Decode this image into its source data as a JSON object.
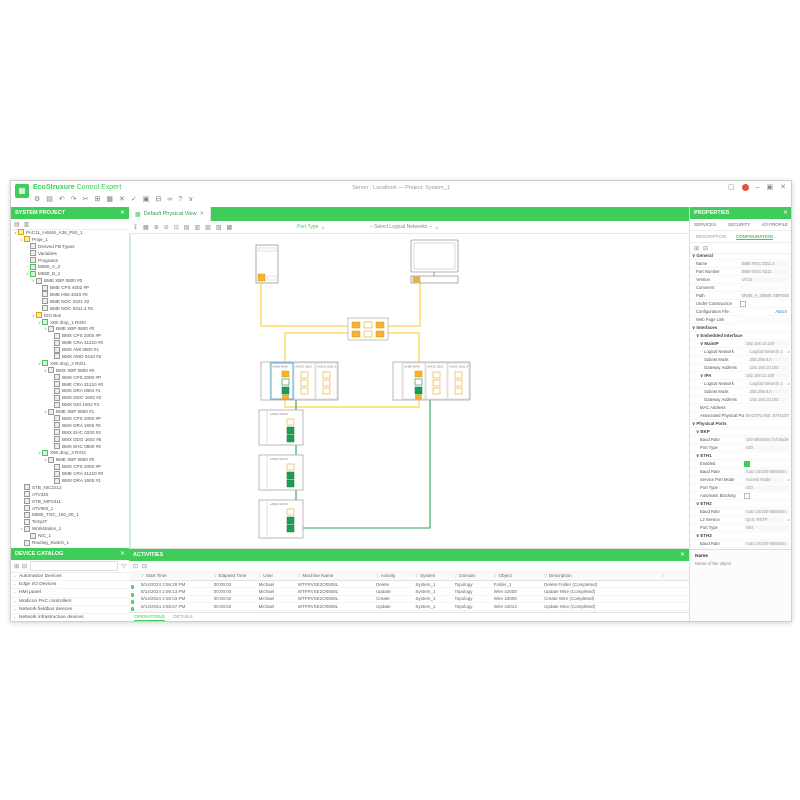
{
  "window": {
    "brand_primary": "EcoStruxure",
    "brand_secondary": "Control Expert",
    "title_center": "Server : Localhost — Project: System_1",
    "logo_glyph": "▦",
    "controls": [
      {
        "name": "layout-icon",
        "g": "▢"
      },
      {
        "name": "record-indicator",
        "g": "●"
      },
      {
        "name": "minimize-icon",
        "g": "–"
      },
      {
        "name": "maximize-icon",
        "g": "▣"
      },
      {
        "name": "close-icon",
        "g": "✕"
      }
    ]
  },
  "main_toolbar": {
    "icons": [
      {
        "name": "settings-icon",
        "g": "⚙"
      },
      {
        "name": "open-project-icon",
        "g": "▤"
      },
      {
        "name": "undo-icon",
        "g": "↶"
      },
      {
        "name": "redo-icon",
        "g": "↷"
      },
      {
        "name": "cut-icon",
        "g": "✂"
      },
      {
        "name": "copy-icon",
        "g": "⊞"
      },
      {
        "name": "paste-icon",
        "g": "▦"
      },
      {
        "name": "delete-icon",
        "g": "✕"
      },
      {
        "name": "validate-icon",
        "g": "✓"
      },
      {
        "name": "build-icon",
        "g": "▣"
      },
      {
        "name": "print-icon",
        "g": "⊟"
      },
      {
        "name": "refresh-icon",
        "g": "∞"
      },
      {
        "name": "help-icon",
        "g": "?"
      },
      {
        "name": "more-icon",
        "g": "∨"
      }
    ]
  },
  "left": {
    "project_panel": {
      "title": "SYSTEM PROJECT",
      "close_glyph": "✕",
      "tool_icons": [
        {
          "name": "expand-all-icon",
          "g": "▤"
        },
        {
          "name": "collapse-all-icon",
          "g": "▥"
        }
      ],
      "tree": [
        {
          "d": 0,
          "e": "v",
          "k": "f",
          "t": "PAC11_H4848_A38_P82_1"
        },
        {
          "d": 1,
          "e": "v",
          "k": "f",
          "t": "Proje_1"
        },
        {
          "d": 2,
          "e": ">",
          "k": "d",
          "t": "Derived FB Types"
        },
        {
          "d": 2,
          "e": "",
          "k": "d",
          "t": "Variables"
        },
        {
          "d": 2,
          "e": ">",
          "k": "d",
          "t": "Programs"
        },
        {
          "d": 2,
          "e": ">",
          "k": "p",
          "t": "M580_A_2"
        },
        {
          "d": 2,
          "e": "v",
          "k": "p",
          "t": "M580_B_2"
        },
        {
          "d": 3,
          "e": "v",
          "k": "d",
          "t": "BME XBP 0800 #0"
        },
        {
          "d": 4,
          "e": "",
          "k": "d",
          "t": "BME CPS 4002 #P"
        },
        {
          "d": 4,
          "e": "",
          "k": "d",
          "t": "BME H58 4040 #0"
        },
        {
          "d": 4,
          "e": "",
          "k": "d",
          "t": "BME NOC 0321 #2"
        },
        {
          "d": 4,
          "e": "",
          "k": "d",
          "t": "BME NOC 0311.4 #3"
        },
        {
          "d": 3,
          "e": "v",
          "k": "f",
          "t": "EIO Bus"
        },
        {
          "d": 4,
          "e": "v",
          "k": "p",
          "t": "X80 drop_1 RIO0"
        },
        {
          "d": 5,
          "e": "v",
          "k": "d",
          "t": "BME XBP 0800 #0"
        },
        {
          "d": 6,
          "e": "",
          "k": "d",
          "t": "BMX CPS 2000 #P"
        },
        {
          "d": 6,
          "e": "",
          "k": "d",
          "t": "BME CRA 31210 #0"
        },
        {
          "d": 6,
          "e": "",
          "k": "d",
          "t": "BMX AMI 0800 #1"
        },
        {
          "d": 6,
          "e": "",
          "k": "d",
          "t": "BMX AMO 0410 #2"
        },
        {
          "d": 4,
          "e": "v",
          "k": "p",
          "t": "X80 drop_2 RIO1"
        },
        {
          "d": 5,
          "e": "v",
          "k": "d",
          "t": "BMX XBP 0800 #0"
        },
        {
          "d": 6,
          "e": "",
          "k": "d",
          "t": "BMX CPS 2000 #P"
        },
        {
          "d": 6,
          "e": "",
          "k": "d",
          "t": "BME CRA 31210 #0"
        },
        {
          "d": 6,
          "e": "",
          "k": "d",
          "t": "BMX DRA 0804 #1"
        },
        {
          "d": 6,
          "e": "",
          "k": "d",
          "t": "BMX DDO 1602 #2"
        },
        {
          "d": 6,
          "e": "",
          "k": "d",
          "t": "BMX DDI 1602 #3"
        },
        {
          "d": 5,
          "e": "v",
          "k": "d",
          "t": "BME XBP 0800 #1"
        },
        {
          "d": 6,
          "e": "",
          "k": "d",
          "t": "BMX CPS 2000 #P"
        },
        {
          "d": 6,
          "e": "",
          "k": "d",
          "t": "BMX DRA 1605 #0"
        },
        {
          "d": 6,
          "e": "",
          "k": "d",
          "t": "BMX EHC 0200 #4"
        },
        {
          "d": 6,
          "e": "",
          "k": "d",
          "t": "BMX DDO 1602 #5"
        },
        {
          "d": 6,
          "e": "",
          "k": "d",
          "t": "BMX EHC 0800 #6"
        },
        {
          "d": 4,
          "e": "v",
          "k": "p",
          "t": "X80 drop_3 RIO2"
        },
        {
          "d": 5,
          "e": "v",
          "k": "d",
          "t": "BME XBP 0800 #0"
        },
        {
          "d": 6,
          "e": "",
          "k": "d",
          "t": "BMX CPS 2000 #P"
        },
        {
          "d": 6,
          "e": "",
          "k": "d",
          "t": "BME CRA 31210 #0"
        },
        {
          "d": 6,
          "e": "",
          "k": "d",
          "t": "BMX DRA 1605 #1"
        },
        {
          "d": 1,
          "e": "",
          "k": "d",
          "t": "STB_NIC2212"
        },
        {
          "d": 1,
          "e": "",
          "k": "d",
          "t": "ATV340"
        },
        {
          "d": 1,
          "e": "",
          "k": "d",
          "t": "STB_NIP2311"
        },
        {
          "d": 1,
          "e": "",
          "k": "d",
          "t": "ATV950_1"
        },
        {
          "d": 1,
          "e": "",
          "k": "d",
          "t": "M580_TOC_160_00_1"
        },
        {
          "d": 1,
          "e": "",
          "k": "d",
          "t": "TeSysT"
        },
        {
          "d": 1,
          "e": "v",
          "k": "d",
          "t": "Workstation_1"
        },
        {
          "d": 2,
          "e": "",
          "k": "d",
          "t": "NIC_1"
        },
        {
          "d": 1,
          "e": "",
          "k": "d",
          "t": "Routing_Switch_1"
        }
      ]
    },
    "catalog_panel": {
      "title": "DEVICE CATALOG",
      "close_glyph": "✕",
      "tool_icons": [
        {
          "name": "import-icon",
          "g": "⊞"
        },
        {
          "name": "export-icon",
          "g": "⊟"
        }
      ],
      "search_placeholder": "",
      "filter_glyph": "▽",
      "items": [
        "Automation Devices",
        "Edge I/O Devices",
        "HMI panel",
        "Modicon PAC controllers",
        "Network fieldbus devices",
        "Network infrastructure devices",
        "Workstations & Servers"
      ]
    }
  },
  "canvas": {
    "tab": "Default Physical View",
    "tab_icon": "▦",
    "tab_close": "✕",
    "toolbar_icons": [
      {
        "name": "export-view-icon",
        "g": "↧"
      },
      {
        "name": "grid-icon",
        "g": "▦"
      },
      {
        "name": "zoom-in-icon",
        "g": "⊕"
      },
      {
        "name": "zoom-out-icon",
        "g": "⊖"
      },
      {
        "name": "zoom-fit-icon",
        "g": "⊡"
      },
      {
        "name": "layout-horizontal-icon",
        "g": "▤"
      },
      {
        "name": "layout-vertical-icon",
        "g": "▥"
      },
      {
        "name": "align-left-icon",
        "g": "▧"
      },
      {
        "name": "align-right-icon",
        "g": "▨"
      },
      {
        "name": "distribute-icon",
        "g": "▩"
      }
    ],
    "port_type_label": "Port Type",
    "port_type_dd": "∨",
    "network_select": "-- Select Logical Networks --",
    "network_select_dd": "∨",
    "topology": {
      "rack_a_modules": [
        "eH58 4040",
        "eNOC 0321",
        "eNOC 0311.4"
      ],
      "rack_b_modules": [
        "eH58 4040",
        "eNOC 0321",
        "eNOC 0311.4"
      ],
      "drops": [
        "eCRA 31210",
        "eCRA 31210",
        "eCRA 31210"
      ]
    },
    "colors": {
      "wire_yellow": "#ffd966",
      "wire_green": "#2aa05a",
      "port_yellow": "#f5b331",
      "port_green": "#1f9d55",
      "selection_blue": "#5aaae0"
    }
  },
  "activities": {
    "title": "ACTIVITIES",
    "pin_glyph": "✕",
    "tool_icons": [
      {
        "name": "export-log-icon",
        "g": "⊡"
      },
      {
        "name": "clear-log-icon",
        "g": "⊟"
      }
    ],
    "filter_glyph": "▽",
    "status_glyph": "✓",
    "columns": [
      "Start Time",
      "Elapsed Time",
      "User",
      "Machine Name",
      "Activity",
      "System",
      "Domain",
      "Object",
      "Description"
    ],
    "col_widths": [
      13,
      8,
      7,
      14,
      7,
      7,
      7,
      9,
      21
    ],
    "rows": [
      [
        "8/14/2024 2:56:29 PM",
        "00:00:02",
        "Michael",
        "WTFRVSE2O0508L",
        "Delete",
        "System_1",
        "Topology",
        "Folder_1",
        "Delete Folder (Completed)"
      ],
      [
        "8/14/2024 2:56:13 PM",
        "00:00:00",
        "Michael",
        "WTFRVSE2O0508L",
        "Update",
        "System_1",
        "Topology",
        "Wire 42008",
        "Update Wire (Completed)"
      ],
      [
        "8/14/2024 2:56:03 PM",
        "00:00:02",
        "Michael",
        "WTFRVSE2O0508L",
        "Create",
        "System_1",
        "Topology",
        "Wire 42008",
        "Create Wire (Completed)"
      ],
      [
        "8/14/2024 2:55:57 PM",
        "00:00:02",
        "Michael",
        "WTFRVSE2O0508L",
        "Update",
        "System_1",
        "Topology",
        "Wire 42014",
        "Update Wire (Completed)"
      ],
      [
        "8/14/2024 2:55:51 PM",
        "00:00:00",
        "Michael",
        "WTFRVSE2O0508L",
        "Move",
        "System_1",
        "Topology",
        "Server_1",
        "Move Device (Completed)"
      ]
    ],
    "footer_tabs": [
      {
        "label": "OPERATIONS",
        "active": true
      },
      {
        "label": "DETAILS",
        "active": false
      }
    ]
  },
  "properties": {
    "title": "PROPERTIES",
    "pin_glyph": "✕",
    "tabs": [
      "SERVICES",
      "SECURITY",
      "I/O PROFILE"
    ],
    "subtabs": [
      {
        "label": "DESCRIPTION",
        "active": false
      },
      {
        "label": "CONFIGURATION",
        "active": true
      }
    ],
    "tool_icons": [
      {
        "name": "expand-sections-icon",
        "g": "⊞"
      },
      {
        "name": "collapse-sections-icon",
        "g": "⊟"
      }
    ],
    "rows": [
      {
        "t": "sec",
        "i": 0,
        "l": "General"
      },
      {
        "t": "txt",
        "i": 1,
        "l": "Name",
        "v": "BME NOC 0311.4"
      },
      {
        "t": "txt",
        "i": 1,
        "l": "Part Number",
        "v": "BME-NOC-0311"
      },
      {
        "t": "txt",
        "i": 1,
        "l": "Version",
        "v": "V0.01"
      },
      {
        "t": "txt",
        "i": 1,
        "l": "Comment",
        "v": ""
      },
      {
        "t": "txt",
        "i": 1,
        "l": "Path",
        "v": "M580_A_2\\BME XBP0800"
      },
      {
        "t": "chk",
        "i": 1,
        "l": "Under Construction",
        "v": false
      },
      {
        "t": "link",
        "i": 1,
        "l": "Configuration File",
        "v": "Attach"
      },
      {
        "t": "txt",
        "i": 1,
        "l": "Web Page Link",
        "v": ""
      },
      {
        "t": "sec",
        "i": 0,
        "l": "Interfaces"
      },
      {
        "t": "sec",
        "i": 1,
        "l": "Embedded Interface"
      },
      {
        "t": "sech",
        "i": 2,
        "l": "MainIP",
        "v": "192.168.10.100"
      },
      {
        "t": "dd",
        "i": 3,
        "l": "Logical Network",
        "v": "Logical Network 1"
      },
      {
        "t": "txt",
        "i": 3,
        "l": "Subnet Mask",
        "v": "255.255.0.0"
      },
      {
        "t": "txt",
        "i": 3,
        "l": "Gateway Address",
        "v": "192.168.10.100"
      },
      {
        "t": "sech",
        "i": 2,
        "l": "IPA",
        "v": "192.168.11.100"
      },
      {
        "t": "dd",
        "i": 3,
        "l": "Logical Network",
        "v": "Logical Network 1"
      },
      {
        "t": "txt",
        "i": 3,
        "l": "Subnet Mask",
        "v": "255.255.0.0"
      },
      {
        "t": "txt",
        "i": 3,
        "l": "Gateway Address",
        "v": "192.168.10.100"
      },
      {
        "t": "txt",
        "i": 2,
        "l": "MAC Address",
        "v": ""
      },
      {
        "t": "txt",
        "i": 2,
        "l": "Associated Physical Ports",
        "v": "BACKPLANE, ETH1/ETH2"
      },
      {
        "t": "sec",
        "i": 0,
        "l": "Physical Ports"
      },
      {
        "t": "sec",
        "i": 1,
        "l": "BKP"
      },
      {
        "t": "txt",
        "i": 2,
        "l": "Baud Rate",
        "v": "100 Mbits/sec full duplex"
      },
      {
        "t": "txt",
        "i": 2,
        "l": "Port Type",
        "v": "SIO"
      },
      {
        "t": "sec",
        "i": 1,
        "l": "ETH1"
      },
      {
        "t": "chk2",
        "i": 2,
        "l": "Enabled",
        "v": true
      },
      {
        "t": "txt",
        "i": 2,
        "l": "Baud Rate",
        "v": "Auto 10/100 Mbits/sec"
      },
      {
        "t": "dd",
        "i": 2,
        "l": "Service Port Mode",
        "v": "Access Mode"
      },
      {
        "t": "txt",
        "i": 2,
        "l": "Port Type",
        "v": "SIO"
      },
      {
        "t": "chk",
        "i": 2,
        "l": "Automatic Blocking",
        "v": false
      },
      {
        "t": "sec",
        "i": 1,
        "l": "ETH2"
      },
      {
        "t": "txt",
        "i": 2,
        "l": "Baud Rate",
        "v": "Auto 10/100 Mbits/sec"
      },
      {
        "t": "dd",
        "i": 2,
        "l": "L2 Service",
        "v": "QoS, RSTP"
      },
      {
        "t": "txt",
        "i": 2,
        "l": "Port Type",
        "v": "NIO"
      },
      {
        "t": "sec",
        "i": 1,
        "l": "ETH3"
      },
      {
        "t": "txt",
        "i": 2,
        "l": "Baud Rate",
        "v": "Auto 10/100 Mbits/sec"
      },
      {
        "t": "dd",
        "i": 2,
        "l": "L2 Service",
        "v": "QoS, RSTP"
      }
    ],
    "footer_title": "Name",
    "footer_text": "Name of the object"
  }
}
